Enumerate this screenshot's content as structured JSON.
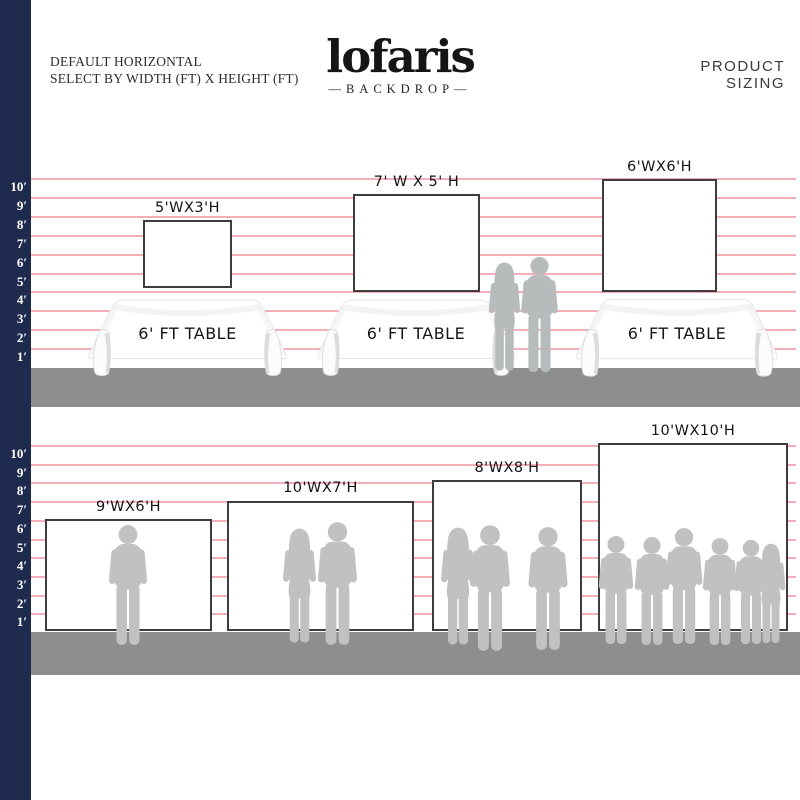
{
  "header": {
    "subtitle_line1": "DEFAULT HORIZONTAL",
    "subtitle_line2": "SELECT BY WIDTH (FT) X HEIGHT (FT)",
    "logo": "lofaris",
    "logo_sub": "—BACKDROP—",
    "product_sizing": "PRODUCT SIZING"
  },
  "colors": {
    "navy": "#1f2b4e",
    "pink_line": "#f09aa6",
    "floor": "#8e8e8e",
    "silhouette": "#c1c1c1",
    "backdrop_border": "#3d3d3d"
  },
  "ruler_labels": [
    "10′",
    "9′",
    "8′",
    "7′",
    "6′",
    "5′",
    "4′",
    "3′",
    "2′",
    "1′"
  ],
  "section1": {
    "backdrops": [
      {
        "label": "5'WX3'H"
      },
      {
        "label": "7' W X 5' H"
      },
      {
        "label": "6'WX6'H"
      }
    ],
    "table_label": "6' FT TABLE"
  },
  "section2": {
    "backdrops": [
      {
        "label": "9'WX6'H"
      },
      {
        "label": "10'WX7'H"
      },
      {
        "label": "8'WX8'H"
      },
      {
        "label": "10'WX10'H"
      }
    ]
  }
}
